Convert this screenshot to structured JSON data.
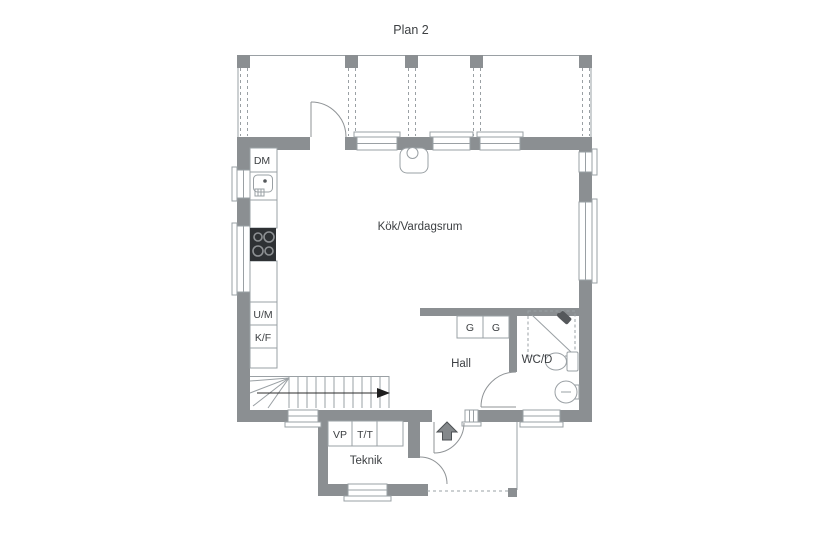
{
  "title": "Plan 2",
  "rooms": {
    "kitchen_living": "Kök/Vardagsrum",
    "hall": "Hall",
    "wc_shower": "WC/D",
    "utility": "Teknik"
  },
  "fixtures": {
    "dishwasher": "DM",
    "oven_microwave": "U/M",
    "fridge_freezer": "K/F",
    "heat_pump": "VP",
    "washer_dryer": "T/T",
    "wardrobe_left": "G",
    "wardrobe_right": "G"
  },
  "colors": {
    "wall": "#8b8f92",
    "thin_line": "#9aa0a4",
    "text": "#3d4043",
    "stove": "#2e3134",
    "arrow": "#1e1e1e"
  }
}
